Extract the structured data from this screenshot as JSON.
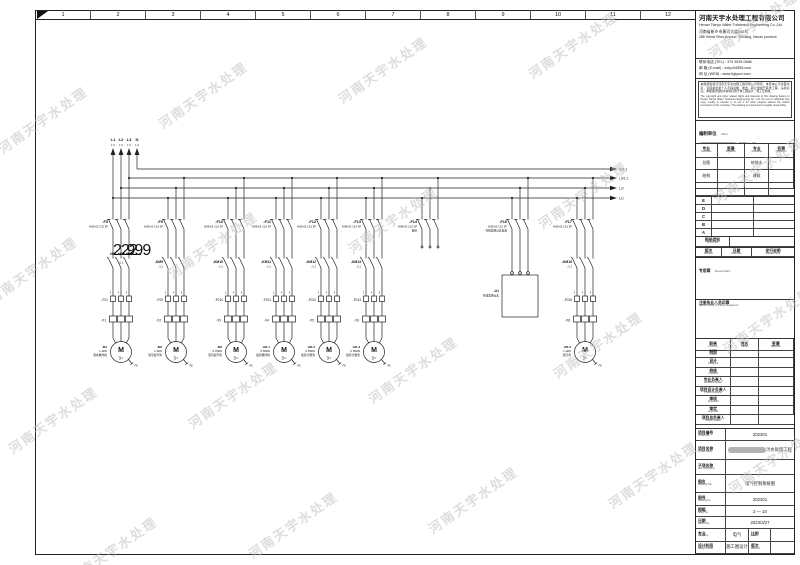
{
  "watermark": {
    "text": "河南天宇水处理",
    "color": "#c3c3c3",
    "positions": [
      [
        -10,
        110
      ],
      [
        150,
        85
      ],
      [
        330,
        60
      ],
      [
        520,
        35
      ],
      [
        700,
        15
      ],
      [
        -20,
        260
      ],
      [
        160,
        235
      ],
      [
        340,
        210
      ],
      [
        530,
        185
      ],
      [
        705,
        160
      ],
      [
        0,
        410
      ],
      [
        180,
        385
      ],
      [
        360,
        360
      ],
      [
        545,
        335
      ],
      [
        715,
        310
      ],
      [
        60,
        540
      ],
      [
        240,
        515
      ],
      [
        420,
        490
      ],
      [
        600,
        465
      ],
      [
        720,
        450
      ]
    ]
  },
  "ruler": {
    "numbers": [
      "1",
      "2",
      "3",
      "4",
      "5",
      "6",
      "7",
      "8",
      "9",
      "10",
      "11",
      "12"
    ]
  },
  "title_block": {
    "company": {
      "name_cn": "河南天宇水处理工程有限公司",
      "name_en": "Henan Tianyu Water Treatment Engineering Co.,Ltd.",
      "address_cn": "河南省新乡市黄河大道288号",
      "address_en": "288 Yellow River Avenue, Xinxiang, Henan province"
    },
    "contacts": [
      "联系电话 (TEL) : 373 3535 0686",
      "邮  箱 (E-mail) : xxtyu34555.com",
      "网  址 (WEB) : www.hgtyscl.com"
    ],
    "disclaimer_cn": "本图纸版权归河南天宇水处理工程有限公司所有，未经本公司书面许可，任何单位和个人不得复制、修改、转让或用于其他工程，违者必究。本图纸所载技术资料仅用于本工程设计、施工及验收。",
    "disclaimer_en": "The copyright and other related rights and interests of this drawing belong to Henan Tianyu Water Treatment Engineering Co., Ltd. No unit or individual may copy, modify or transfer it, or use it for other projects without the written permission of the company. The drawing is reserved to be legally responsible.",
    "client": {
      "label_cn": "编制单位",
      "label_en": "Client",
      "value_suffix": "有限公司",
      "redacted": true
    },
    "sig_table": {
      "headers": [
        {
          "cn": "专业",
          "en": "Discipline"
        },
        {
          "cn": "签署",
          "en": "Signature"
        },
        {
          "cn": "专业",
          "en": "Discipline"
        },
        {
          "cn": "签署",
          "en": "Signature"
        }
      ],
      "rows": [
        [
          "总图",
          "",
          "给排水",
          ""
        ],
        [
          "结构",
          "",
          "建筑",
          ""
        ],
        [
          "",
          "",
          "",
          ""
        ],
        [
          "",
          "",
          "",
          ""
        ]
      ]
    },
    "revision_letters": [
      "E",
      "D",
      "C",
      "B",
      "A"
    ],
    "print_issue": {
      "cn": "图纸类别",
      "en": "Print Issue"
    },
    "rev_header": [
      {
        "cn": "版次",
        "en": "Revision"
      },
      {
        "cn": "日期",
        "en": "Rev Date"
      },
      {
        "cn": "发行说明",
        "en": "Release Note"
      }
    ],
    "special_stamp": {
      "cn": "专用章",
      "en": "Special Stamp"
    },
    "registered_stamp": {
      "cn": "注册执业人员印章",
      "en": "Special Stamp Of Person Registered"
    },
    "personnel": {
      "headers": [
        {
          "cn": "职责",
          "en": "Function"
        },
        {
          "cn": "姓名",
          "en": "Name"
        },
        {
          "cn": "签署",
          "en": "Signature"
        }
      ],
      "rows": [
        {
          "cn": "制图",
          "en": "Drawn"
        },
        {
          "cn": "设计",
          "en": "Designed"
        },
        {
          "cn": "校核",
          "en": "Checked"
        },
        {
          "cn": "专业负责人",
          "en": "Discipline Leader"
        },
        {
          "cn": "项目设计负责人",
          "en": "Project Designer"
        },
        {
          "cn": "审核",
          "en": "Reviewed"
        },
        {
          "cn": "审定",
          "en": "Approved"
        },
        {
          "cn": "项目总负责人",
          "en": "Project Leader"
        }
      ]
    },
    "fields": [
      {
        "cn": "项目编号",
        "en": "Project No.",
        "value": "202301",
        "blob": false
      },
      {
        "cn": "项目名称",
        "en": "Project Name",
        "value": "污水处理工程",
        "blob": true
      },
      {
        "cn": "子项名称",
        "en": "Sub-Item Name",
        "value": "",
        "blob": false
      },
      {
        "cn": "图名",
        "en": "Drawing Title",
        "value": "电气控制系统图",
        "blob": false
      },
      {
        "cn": "图号",
        "en": "Drawing No.",
        "value": "202301",
        "blob": false
      },
      {
        "cn": "图幅",
        "en": "Sheet No.",
        "value": "2 — 10",
        "blob": false
      },
      {
        "cn": "日期",
        "en": "Issue Date",
        "value": "2023/3/27",
        "blob": false
      }
    ],
    "split_fields": [
      {
        "cn": "专业",
        "en": "Discipline",
        "value": "电气",
        "cn2": "比例",
        "en2": "Scale",
        "value2": ""
      },
      {
        "cn": "设计阶段",
        "en": "Design Phase",
        "value": "施工图设计",
        "cn2": "版次",
        "en2": "Revision",
        "value2": ""
      }
    ]
  },
  "schematic": {
    "supply": {
      "labels": [
        "L1",
        "L2",
        "L3",
        "N"
      ],
      "refs": [
        "1.0",
        "1.0",
        "1.0",
        "1.0"
      ]
    },
    "bus_labels": [
      "N/1.1",
      "L3/1.1",
      "L2/",
      "L1/"
    ],
    "pole_refs": [
      "2",
      "4",
      "6"
    ],
    "pe_label": "PE",
    "motor_glyph": {
      "m": "M",
      "phase": "3~"
    },
    "feeders": [
      {
        "x": 121,
        "name": "-F5",
        "spec": "NXB-63 C32 3P",
        "kind": "motor",
        "contactors": [
          "KM1",
          "KM2",
          "KM3"
        ],
        "aux": "/1.1",
        "thermal": "-F01",
        "strip": "-X1",
        "motor": {
          "name": "-M1",
          "power": "1.1kW",
          "desc": "潜水搅拌机"
        }
      },
      {
        "x": 176,
        "name": "-F9",
        "spec": "NXB-63 C16 3P",
        "kind": "motor",
        "contactors": [
          "-KM9"
        ],
        "aux": "/1.1",
        "thermal": "-F09",
        "strip": "-X2",
        "motor": {
          "name": "-M2",
          "power": "1.1kW",
          "desc": "潜污提升泵"
        }
      },
      {
        "x": 236,
        "name": "-F10",
        "spec": "NXB-63 C16 3P",
        "kind": "motor",
        "contactors": [
          "-KM10"
        ],
        "aux": "/1.1",
        "thermal": "-F010",
        "strip": "-X3",
        "motor": {
          "name": "-M3",
          "power": "0.75kW",
          "desc": "潜污提升泵"
        }
      },
      {
        "x": 284,
        "name": "-F11",
        "spec": "NXB-63 C16 3P",
        "kind": "motor",
        "contactors": [
          "-KM11"
        ],
        "aux": "/1.1",
        "thermal": "-F011",
        "strip": "-X4",
        "motor": {
          "name": "-M1.1",
          "power": "0.55kW",
          "desc": "加药搅拌机"
        }
      },
      {
        "x": 329,
        "name": "-F12",
        "spec": "NXB-63 C16 3P",
        "kind": "motor",
        "contactors": [
          "-KM12"
        ],
        "aux": "/1.1",
        "thermal": "-F012",
        "strip": "-X5",
        "motor": {
          "name": "-M1.2",
          "power": "0.55kW",
          "desc": "加药计量泵"
        }
      },
      {
        "x": 374,
        "name": "-F13",
        "spec": "NXB-63 C16 3P",
        "kind": "motor",
        "contactors": [
          "-KM13"
        ],
        "aux": "/1.1",
        "thermal": "-F013",
        "strip": "-X6",
        "motor": {
          "name": "-M1.3",
          "power": "0.55kW",
          "desc": "加药计量泵"
        }
      },
      {
        "x": 430,
        "name": "-F14",
        "spec": "NXB-63 C10 3P",
        "desc": "备用",
        "kind": "stub"
      },
      {
        "x": 520,
        "name": "-F16",
        "spec": "NXB-63 C10 3P",
        "desc": "在线监测仪表电源",
        "kind": "box",
        "box": {
          "name": "-U1",
          "desc": "在线监测仪表"
        }
      },
      {
        "x": 585,
        "name": "-F17",
        "spec": "NXB-63 C16 3P",
        "kind": "motor",
        "contactors": [
          "-KM16"
        ],
        "aux": "/1.1",
        "thermal": "-F016",
        "strip": "-X8",
        "motor": {
          "name": "-M1.6",
          "power": "1.1kW",
          "desc": "潜污泵"
        }
      }
    ]
  }
}
